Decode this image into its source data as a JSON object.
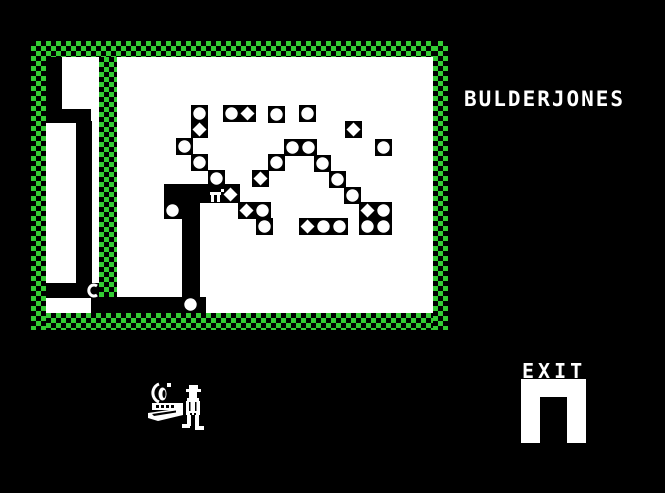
{
  "title": {
    "text": "BULDERJONES"
  },
  "exit": {
    "label": "EXIT",
    "arch": {
      "x": 521,
      "y": 379,
      "w": 65,
      "h": 64,
      "opening": {
        "x": 540,
        "y": 397,
        "w": 27,
        "h": 46
      }
    }
  },
  "colors": {
    "background": "#000000",
    "field": "#ffffff",
    "wall_green": "#33cc33",
    "sprite": "#ffffff"
  },
  "playfield": {
    "checker_walls": [
      {
        "name": "border-top",
        "x": 31,
        "y": 41,
        "w": 417,
        "h": 16
      },
      {
        "name": "border-bottom",
        "x": 31,
        "y": 313,
        "w": 417,
        "h": 17
      },
      {
        "name": "border-left",
        "x": 31,
        "y": 41,
        "w": 15,
        "h": 289
      },
      {
        "name": "border-right",
        "x": 433,
        "y": 41,
        "w": 15,
        "h": 289
      },
      {
        "name": "inner-wall-vertical",
        "x": 99,
        "y": 57,
        "w": 18,
        "h": 240
      }
    ],
    "field_bg": {
      "x": 46,
      "y": 57,
      "w": 387,
      "h": 256
    },
    "black_regions": [
      {
        "name": "left-shaft-top",
        "x": 46,
        "y": 57,
        "w": 16,
        "h": 54
      },
      {
        "name": "left-connector",
        "x": 46,
        "y": 109,
        "w": 45,
        "h": 14
      },
      {
        "name": "left-shaft-lower",
        "x": 76,
        "y": 121,
        "w": 16,
        "h": 163
      },
      {
        "name": "left-bottom-bar",
        "x": 46,
        "y": 283,
        "w": 53,
        "h": 15
      },
      {
        "name": "tunnel-horizontal",
        "x": 164,
        "y": 184,
        "w": 76,
        "h": 19
      },
      {
        "name": "tunnel-elbow",
        "x": 164,
        "y": 202,
        "w": 36,
        "h": 17
      },
      {
        "name": "tunnel-vertical",
        "x": 182,
        "y": 202,
        "w": 18,
        "h": 96
      },
      {
        "name": "tunnel-bottom",
        "x": 91,
        "y": 297,
        "w": 115,
        "h": 16
      }
    ],
    "tiles": [
      {
        "x": 191,
        "y": 105,
        "shape": "boulder"
      },
      {
        "x": 191,
        "y": 121,
        "shape": "diamond"
      },
      {
        "x": 223,
        "y": 105,
        "shape": "boulder"
      },
      {
        "x": 239,
        "y": 105,
        "shape": "diamond"
      },
      {
        "x": 268,
        "y": 106,
        "shape": "boulder"
      },
      {
        "x": 299,
        "y": 105,
        "shape": "boulder"
      },
      {
        "x": 345,
        "y": 121,
        "shape": "diamond"
      },
      {
        "x": 284,
        "y": 139,
        "shape": "boulder"
      },
      {
        "x": 300,
        "y": 139,
        "shape": "boulder"
      },
      {
        "x": 375,
        "y": 139,
        "shape": "boulder"
      },
      {
        "x": 176,
        "y": 138,
        "shape": "boulder"
      },
      {
        "x": 191,
        "y": 154,
        "shape": "boulder"
      },
      {
        "x": 268,
        "y": 154,
        "shape": "boulder"
      },
      {
        "x": 314,
        "y": 155,
        "shape": "boulder"
      },
      {
        "x": 208,
        "y": 170,
        "shape": "boulder"
      },
      {
        "x": 252,
        "y": 170,
        "shape": "diamond"
      },
      {
        "x": 329,
        "y": 171,
        "shape": "boulder"
      },
      {
        "x": 344,
        "y": 187,
        "shape": "boulder"
      },
      {
        "x": 238,
        "y": 202,
        "shape": "diamond"
      },
      {
        "x": 254,
        "y": 202,
        "shape": "boulder"
      },
      {
        "x": 256,
        "y": 218,
        "shape": "boulder"
      },
      {
        "x": 299,
        "y": 218,
        "shape": "diamond"
      },
      {
        "x": 315,
        "y": 218,
        "shape": "boulder"
      },
      {
        "x": 331,
        "y": 218,
        "shape": "boulder"
      },
      {
        "x": 359,
        "y": 202,
        "shape": "diamond"
      },
      {
        "x": 375,
        "y": 202,
        "shape": "boulder"
      },
      {
        "x": 359,
        "y": 218,
        "shape": "boulder"
      },
      {
        "x": 375,
        "y": 218,
        "shape": "boulder"
      },
      {
        "x": 164,
        "y": 202,
        "shape": "boulder"
      },
      {
        "x": 182,
        "y": 296,
        "shape": "boulder"
      },
      {
        "x": 222,
        "y": 186,
        "shape": "diamond"
      }
    ],
    "player": {
      "x": 209,
      "y": 188,
      "desc": "miner-in-tunnel"
    },
    "creature": {
      "x": 86,
      "y": 283,
      "glyph": "C"
    }
  },
  "hud": {
    "life_sprite": {
      "x": 146,
      "y": 380,
      "desc": "miner-with-boat-and-lamp"
    }
  }
}
